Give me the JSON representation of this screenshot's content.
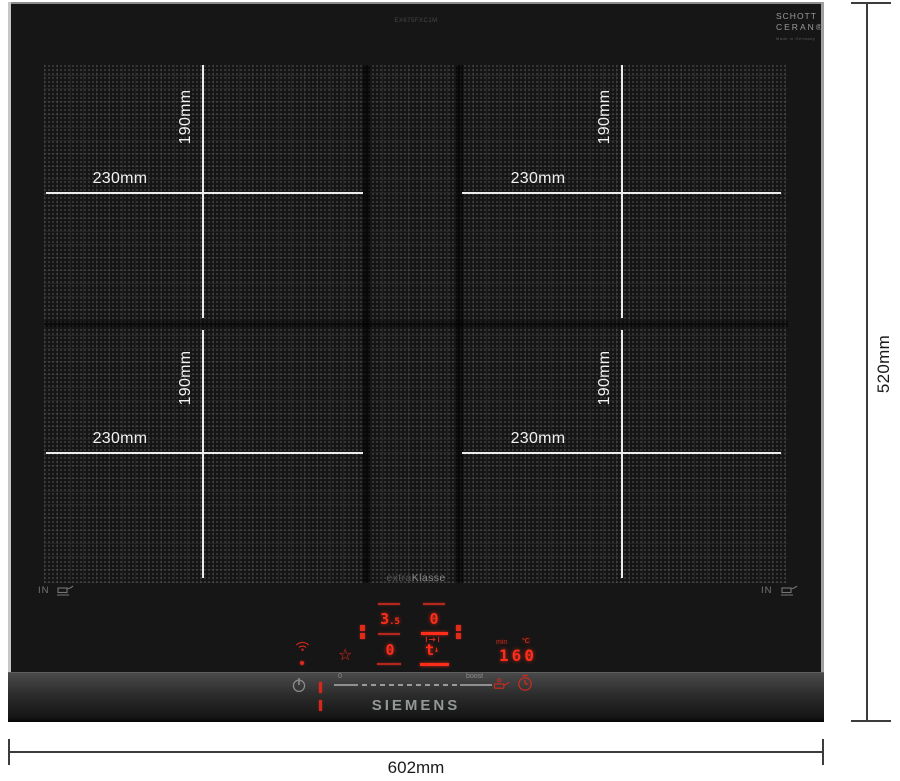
{
  "annotations": {
    "overall_width": "602mm",
    "overall_height": "520mm",
    "zones": [
      {
        "pos": "top-left",
        "width": "230mm",
        "height": "190mm"
      },
      {
        "pos": "top-right",
        "width": "230mm",
        "height": "190mm"
      },
      {
        "pos": "bottom-left",
        "width": "230mm",
        "height": "190mm"
      },
      {
        "pos": "bottom-right",
        "width": "230mm",
        "height": "190mm"
      }
    ]
  },
  "hob": {
    "brand": "SIEMENS",
    "model_number": "EX675FXC1M",
    "series_label_1": "extra",
    "series_label_2": "Klasse",
    "glass_brand": {
      "line1": "SCHOTT",
      "line2": "CERAN®",
      "line3": "Made in Germany"
    },
    "induction_mark_left": "IN",
    "induction_mark_right": "IN"
  },
  "control_panel": {
    "displays": {
      "left_top_value": "3",
      "left_top_decimal": ".5",
      "left_bottom_value": "0",
      "right_top_value": "0",
      "right_bottom_value": "t",
      "temp_value": "160",
      "temp_unit_min": "min",
      "temp_unit_c": "°C"
    },
    "slider": {
      "min_label": "0",
      "max_label": "boost"
    },
    "icons": {
      "star": "☆",
      "arrow_down": "↓"
    },
    "colors": {
      "led_red": "#ff2d1a",
      "led_dim": "#b3271c",
      "icon_gray": "#8a8a8a",
      "glass": "#161616"
    }
  }
}
